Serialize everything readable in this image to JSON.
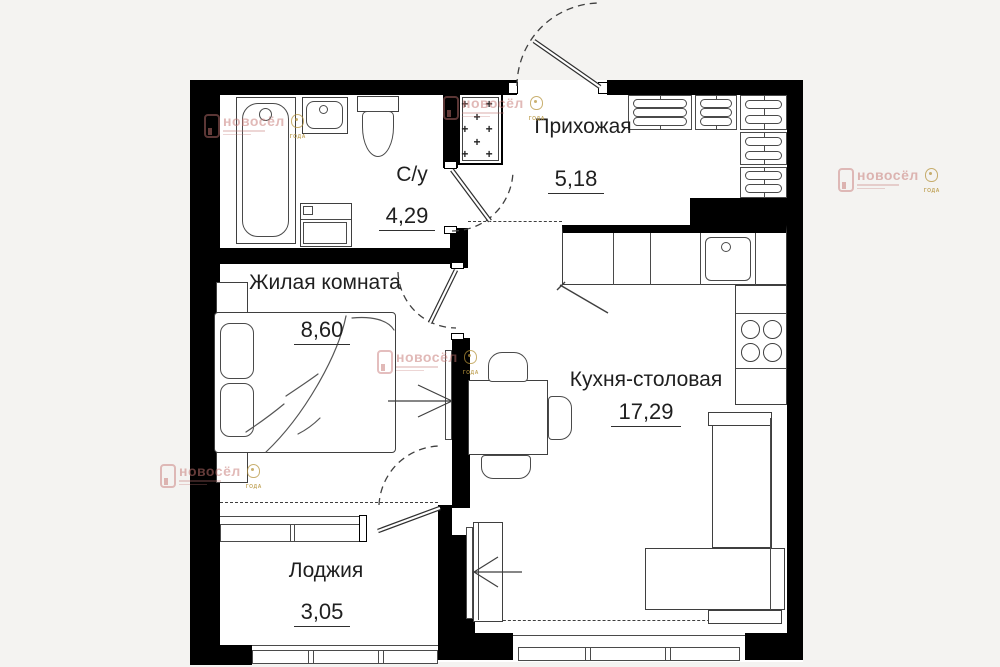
{
  "rooms": [
    {
      "id": "bathroom",
      "name": "С/у",
      "area": "4,29"
    },
    {
      "id": "hallway",
      "name": "Прихожая",
      "area": "5,18"
    },
    {
      "id": "living_room",
      "name": "Жилая комната",
      "area": "8,60"
    },
    {
      "id": "kitchen_dining",
      "name": "Кухня-столовая",
      "area": "17,29"
    },
    {
      "id": "loggia",
      "name": "Лоджия",
      "area": "3,05"
    }
  ],
  "watermark": {
    "brand": "новосёл",
    "emblem_caption": "ГОДА"
  },
  "shaft_pattern": "+ +\n+\n+ +\n+\n+ +",
  "colors": {
    "wall": "#000000",
    "drawing_line": "#3f3f3f",
    "background": "#f4f3f1",
    "floor": "#ffffff",
    "watermark_text": "#c4807d",
    "watermark_gold": "#b5923a"
  }
}
